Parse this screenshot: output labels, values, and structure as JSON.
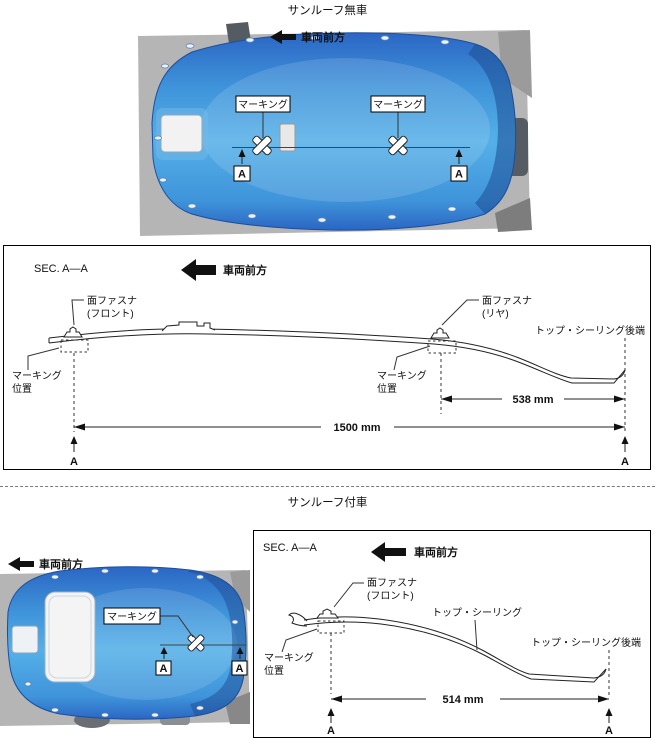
{
  "titles": {
    "no_sunroof": "サンルーフ無車",
    "with_sunroof": "サンルーフ付車"
  },
  "labels": {
    "front_direction": "車両前方",
    "section": "SEC. A—A",
    "marking": "マーキング",
    "marking_pos1": "マーキング",
    "marking_pos2": "位置",
    "fastener": "面ファスナ",
    "fastener_front": "(フロント)",
    "fastener_rear": "(リヤ)",
    "top_ceiling": "トップ・シーリング",
    "top_ceiling_rear": "トップ・シーリング後端",
    "section_marker": "A"
  },
  "dimensions": {
    "total_no_sunroof": "1500 mm",
    "rear_no_sunroof": "538 mm",
    "rear_sunroof": "514 mm"
  },
  "icons": {
    "front_direction_arrow": "left-arrow",
    "marking_cross": "crossed-tape-x",
    "section_pointer": "up-arrow"
  },
  "colors": {
    "headliner_blue": "#3f94da",
    "headliner_blue_dark": "#2563bd",
    "headliner_blue_light": "#5fb5ea",
    "body_gray": "#b5b5b5",
    "line_black": "#1a1a1a"
  }
}
